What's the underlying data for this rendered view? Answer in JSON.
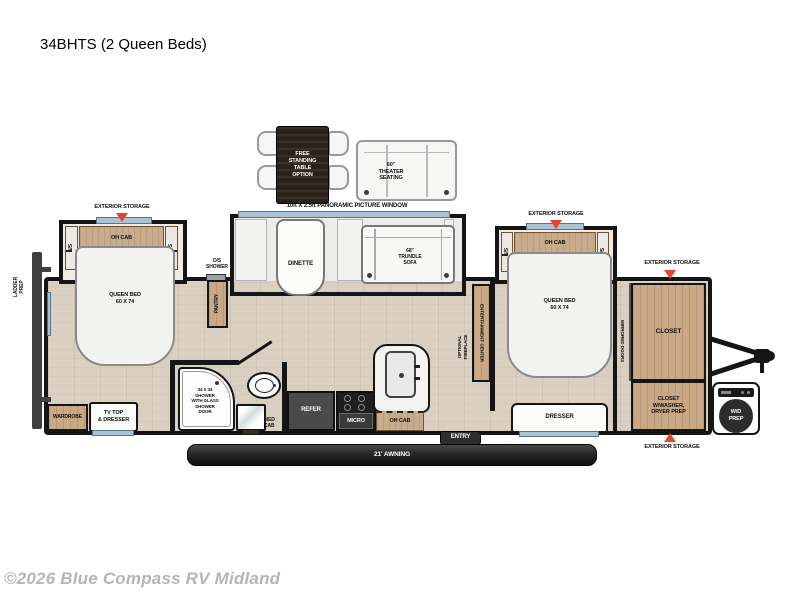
{
  "title": "34BHTS (2 Queen Beds)",
  "footer": {
    "copyright": "©2026 Blue Compass RV Midland"
  },
  "colors": {
    "accent_red": "#e8432e",
    "wall": "#151515",
    "floor_wood": "#d9d0c2",
    "cabinet_wood": "#c9a886",
    "window_glass": "#a9c3d4",
    "awning_dark": "#2b2b2b"
  },
  "labels": {
    "free_standing_table": "FREE\nSTANDING\nTABLE\nOPTION",
    "theater_seating": "60\"\nTHEATER\nSEATING",
    "panoramic_window": "10ft X 2.5ft PANORAMIC PICTURE WINDOW",
    "exterior_storage": "EXTERIOR STORAGE",
    "oh_cab": "OH CAB",
    "ns": "N/S",
    "queen_bed": "QUEEN BED\n60 X 74",
    "ladder_prep": "LADDER\nPREP",
    "wardrobe": "WARDROBE",
    "tv_top_dresser": "TV TOP\n& DRESSER",
    "os_shower": "O/S\nSHOWER",
    "pantry": "PANTRY",
    "shower": "34 X 34\nSHOWER\nWITH GLASS\nSHOWER\nDOOR",
    "med_cab": "MED\nCAB",
    "refer": "REFER",
    "micro": "MICRO",
    "dinette": "DINETTE",
    "trundle_sofa": "68\"\nTRUNDLE\nSOFA",
    "entertainment_center": "ENTERTAINMENT CENTER",
    "optional_fireplace": "OPTIONAL\nFIREPLACE",
    "dresser": "DRESSER",
    "mirrored_doors": "MIRRORED DOORS",
    "closet": "CLOSET",
    "closet_washer": "CLOSET\nW/WASHER,\nDRYER PREP",
    "awning": "21' AWNING",
    "entry": "ENTRY",
    "wd_prep": "W/D\nPREP"
  }
}
